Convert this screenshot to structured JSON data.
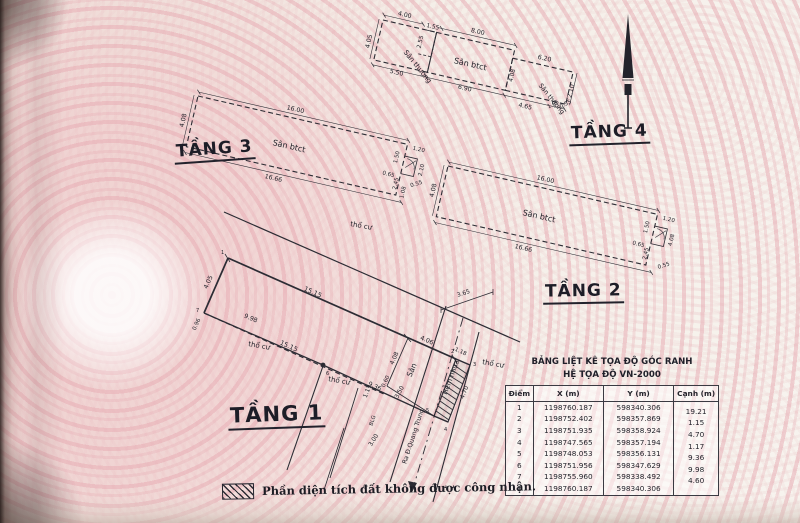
{
  "floors": {
    "t4": {
      "label": "TẦNG 4",
      "area_left": "Sân thượng",
      "area_mid": "Sân btct",
      "area_right": "Sân thượng",
      "dims": {
        "top_left": "4.00",
        "left": "4.05",
        "notch_w": "1.55",
        "notch_h": "2.55",
        "top_mid": "8.00",
        "bottom_left": "5.50",
        "bottom_mid": "6.90",
        "divider": "4.08",
        "top_right": "6.20",
        "right": "2.10",
        "step_a": "1.05",
        "step_b": "0.55",
        "bottom_right": "4.65"
      }
    },
    "t3": {
      "label": "TẦNG 3",
      "area": "Sân btct",
      "dims": {
        "top": "16.00",
        "left": "4.08",
        "bottom": "16.66",
        "e1": "1.20",
        "e2": "1.50",
        "e3": "0.65",
        "e4": "2.10",
        "e5": "0.55",
        "e6": "2.45",
        "e7": "1.08"
      }
    },
    "t2": {
      "label": "TẦNG 2",
      "area": "Sân btct",
      "dims": {
        "top": "16.00",
        "left": "4.08",
        "bottom": "16.66",
        "e1": "1.20",
        "e2": "1.50",
        "e3": "0.65",
        "e4": "4.08",
        "e5": "2.45",
        "e6": "0.55"
      }
    },
    "t1": {
      "label": "TẦNG 1",
      "area_san": "Sân",
      "tho_cu": "thổ cư",
      "road_hem": "Hẻm nhựa",
      "road_out": "Ra Đ.Quang Trung",
      "curb": "BLG",
      "dims": {
        "top_a": "15.15",
        "top_b": "4.06",
        "left": "4.05",
        "left_s": "0.96",
        "dashed": "15.15",
        "low_a": "9.98",
        "low_b": "9.36",
        "san_h": "4.08",
        "san_s": "0.60",
        "hatch_t": "1.18",
        "hatch_len": "4.70",
        "jog": "1.17",
        "road_w": "3.65",
        "gap_a": "3.50",
        "gap_b": "3.00"
      },
      "points": {
        "p1": "1",
        "p2": "2",
        "p3": "3",
        "p4": "4",
        "p5": "5",
        "p6": "6",
        "p7": "7"
      }
    }
  },
  "table": {
    "title_line1": "BẢNG LIỆT KÊ TỌA ĐỘ GÓC RANH",
    "title_line2": "HỆ TỌA ĐỘ VN-2000",
    "headers": [
      "Điểm",
      "X (m)",
      "Y (m)",
      "Cạnh (m)"
    ],
    "rows": [
      [
        "1",
        "1198760.187",
        "598340.306",
        "19.21"
      ],
      [
        "2",
        "1198752.402",
        "598357.869",
        "1.15"
      ],
      [
        "3",
        "1198751.935",
        "598358.924",
        "4.70"
      ],
      [
        "4",
        "1198747.565",
        "598357.194",
        "1.17"
      ],
      [
        "5",
        "1198748.053",
        "598356.131",
        "9.36"
      ],
      [
        "6",
        "1198751.956",
        "598347.629",
        "9.98"
      ],
      [
        "7",
        "1198755.960",
        "598338.492",
        "4.60"
      ],
      [
        "1",
        "1198760.187",
        "598340.306",
        ""
      ]
    ]
  },
  "legend": {
    "text": "Phần diện tích đất không được công nhận."
  }
}
